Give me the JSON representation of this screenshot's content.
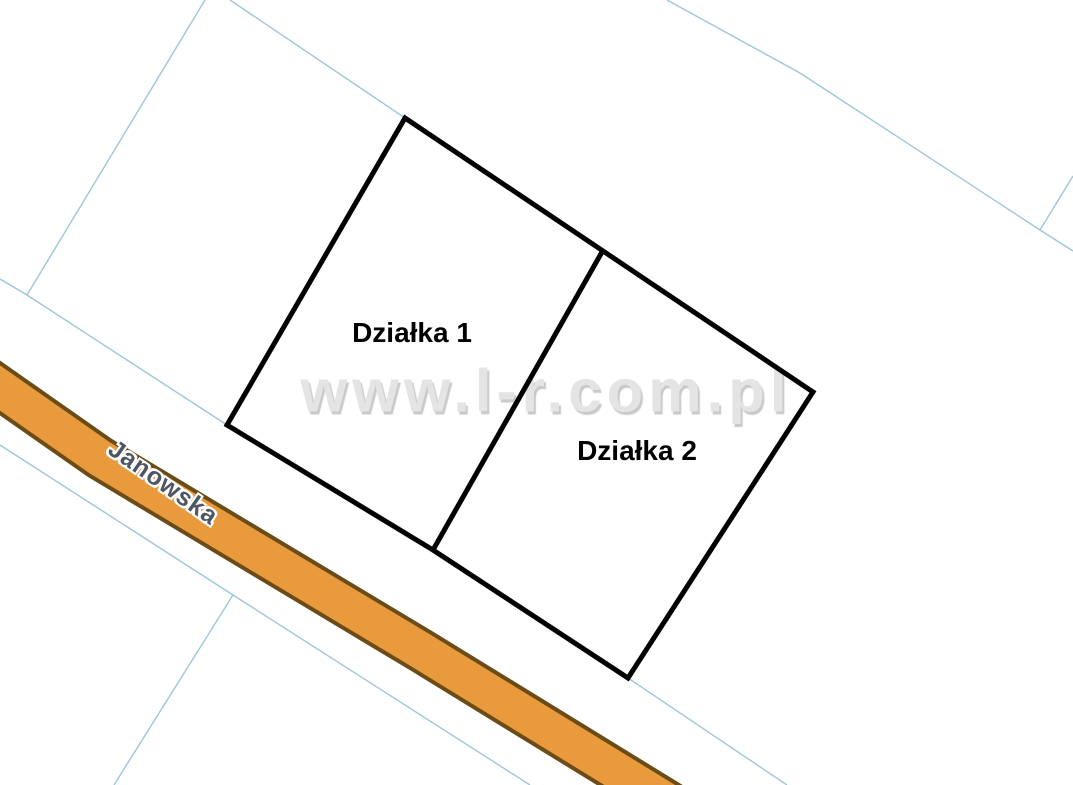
{
  "map": {
    "watermark": "www.l-r.com.pl",
    "street": {
      "name": "Janowska"
    },
    "parcels": [
      {
        "label": "Działka 1"
      },
      {
        "label": "Działka 2"
      }
    ]
  },
  "colors": {
    "background": "#ffffff",
    "parcel_outline": "#000000",
    "parcel_label_color": "#000000",
    "cadastral_line": "#9ec6dc",
    "road_fill": "#e89a3d",
    "road_border": "#6b4c16",
    "street_label_color": "#4f5663",
    "street_label_halo": "#ffffff",
    "watermark_color": "#e4e4e4",
    "watermark_shadow": "#c9c9c9"
  }
}
